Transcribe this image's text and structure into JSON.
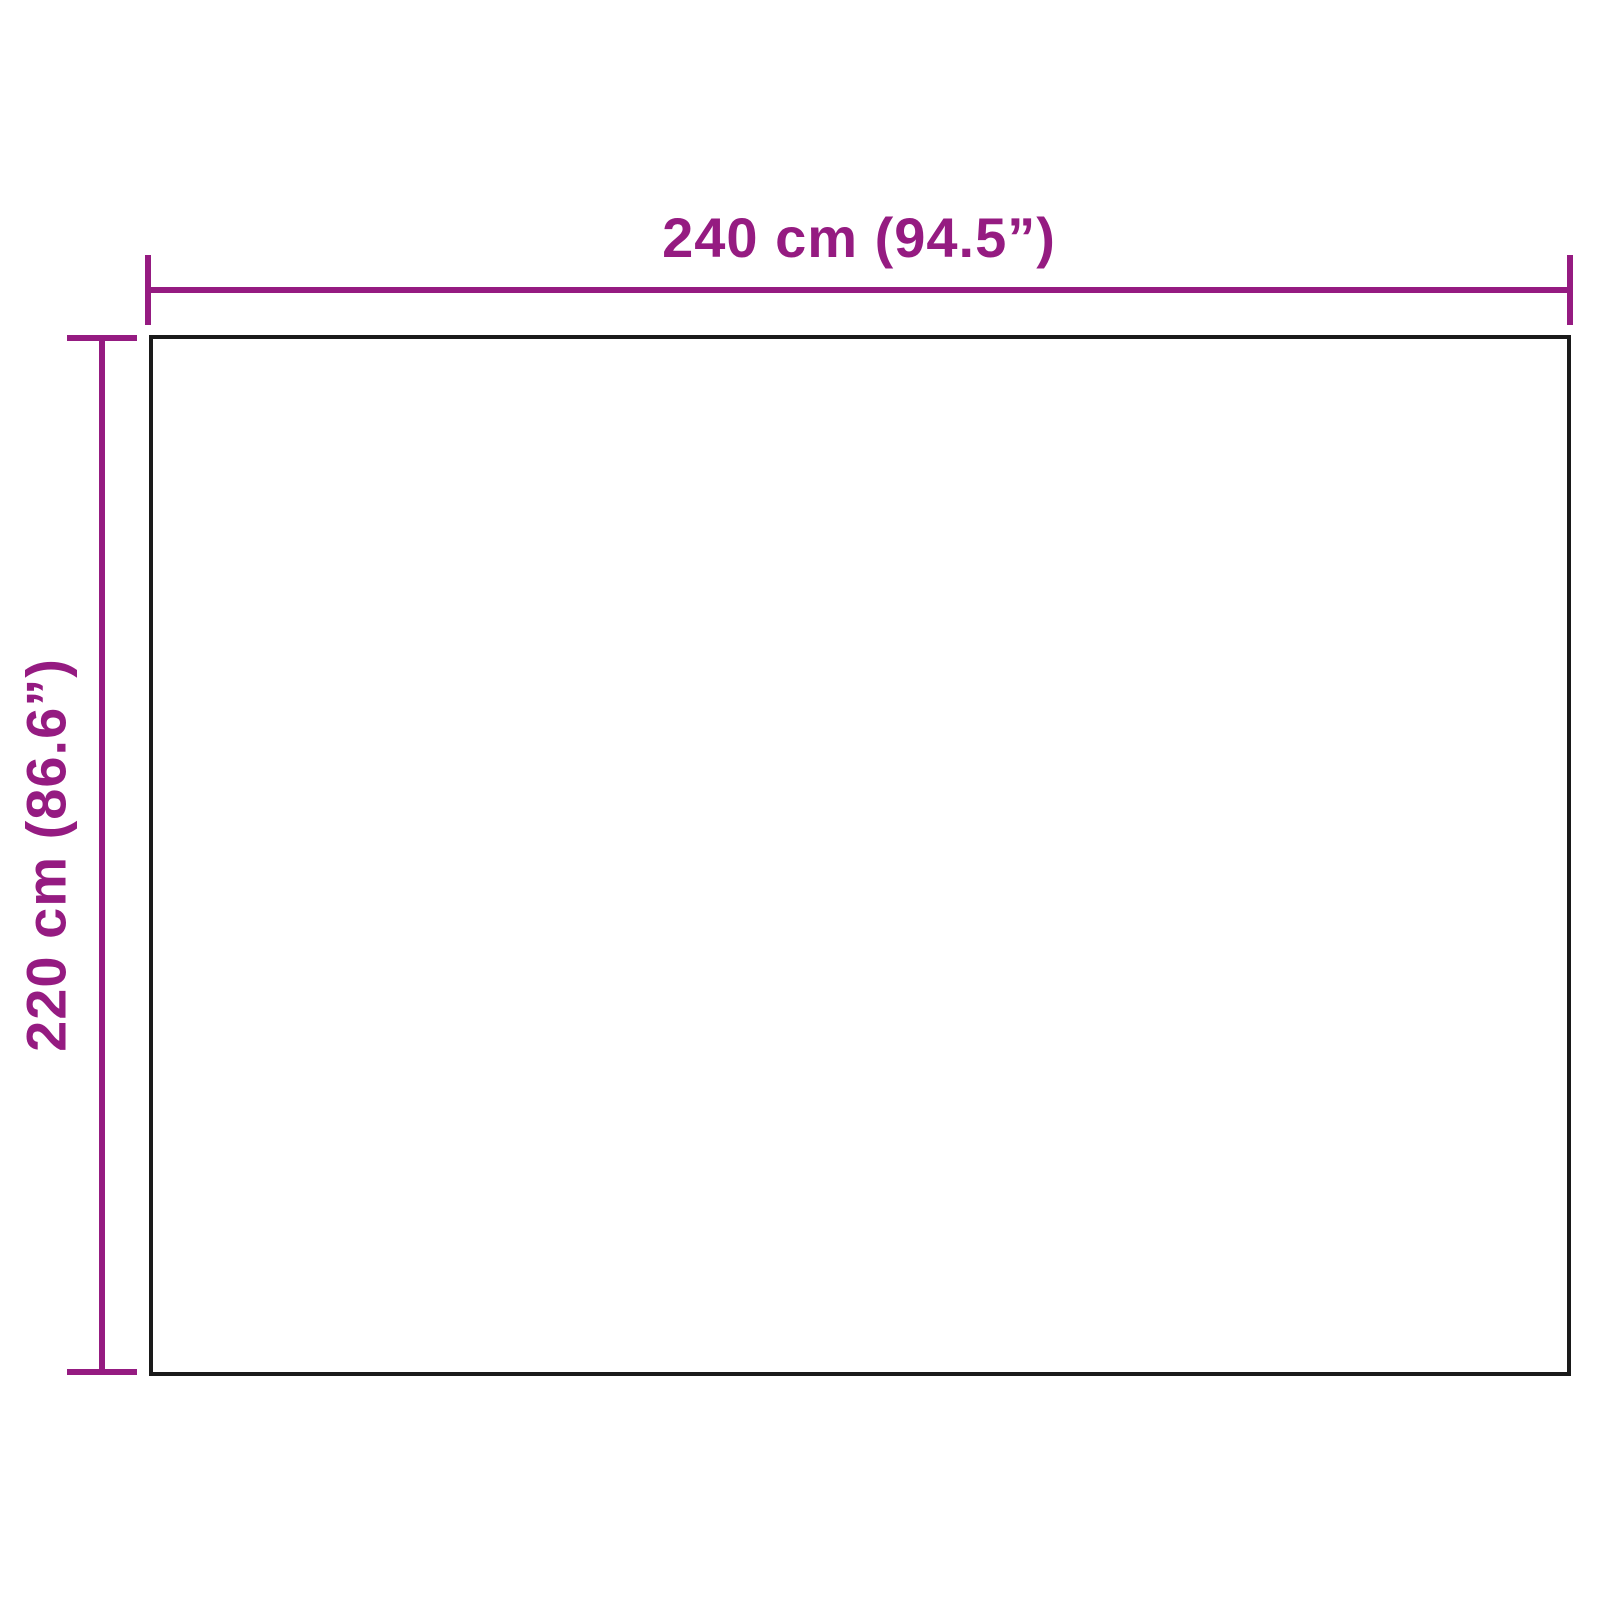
{
  "diagram": {
    "type": "product-dimension-diagram",
    "product_outline": {
      "shape": "rectangle"
    },
    "horizontal_dimension": {
      "label": "240 cm (94.5”)",
      "value_cm": 240,
      "value_in": 94.5
    },
    "vertical_dimension": {
      "label": "220 cm (86.6”)",
      "value_cm": 220,
      "value_in": 86.6
    },
    "colors": {
      "accent": "#951b81",
      "outline": "#1a1a1a",
      "bg": "#ffffff"
    }
  }
}
